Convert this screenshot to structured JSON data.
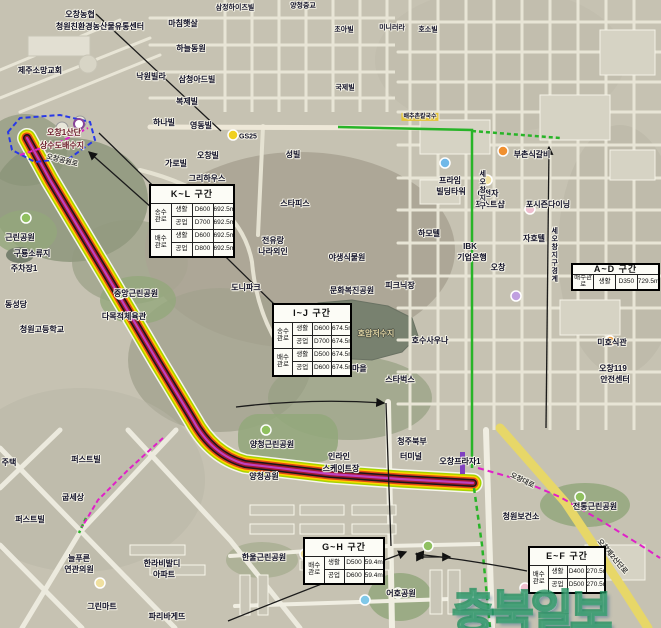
{
  "map": {
    "pipeline": {
      "colors": [
        "#f6f6ee",
        "#a8d400",
        "#ffd400",
        "#e04818",
        "#181818",
        "#a01830",
        "#c040c0"
      ]
    },
    "route_colors": {
      "green": "#28b428",
      "magenta": "#e020c8",
      "blue": "#2838e8",
      "yellow_road": "#e7d768"
    },
    "watermark": {
      "text": "충북일보"
    },
    "tables": [
      {
        "id": "KL",
        "title": "K~L 구간",
        "x": 149,
        "y": 184,
        "w": 86,
        "h": 74,
        "groups": [
          {
            "label": "송수\n관로",
            "rows": [
              [
                "생활",
                "D600",
                "692.5m"
              ],
              [
                "공업",
                "D700",
                "692.5m"
              ]
            ]
          },
          {
            "label": "배수\n관로",
            "rows": [
              [
                "생활",
                "D600",
                "692.5m"
              ],
              [
                "공업",
                "D800",
                "692.5m"
              ]
            ]
          }
        ]
      },
      {
        "id": "IJ",
        "title": "I~J 구간",
        "x": 272,
        "y": 303,
        "w": 80,
        "h": 74,
        "groups": [
          {
            "label": "송수\n관로",
            "rows": [
              [
                "생활",
                "D600",
                "674.5m"
              ],
              [
                "공업",
                "D700",
                "674.5m"
              ]
            ]
          },
          {
            "label": "배수\n관로",
            "rows": [
              [
                "생활",
                "D500",
                "674.5m"
              ],
              [
                "공업",
                "D600",
                "674.5m"
              ]
            ]
          }
        ]
      },
      {
        "id": "AD",
        "title": "A~D 구간",
        "x": 571,
        "y": 263,
        "w": 89,
        "h": 27,
        "groups": [
          {
            "label": "배수관로",
            "rows": [
              [
                "생활",
                "D350",
                "729.5m"
              ]
            ]
          }
        ]
      },
      {
        "id": "GH",
        "title": "G~H 구간",
        "x": 303,
        "y": 537,
        "w": 82,
        "h": 48,
        "groups": [
          {
            "label": "배수\n관로",
            "rows": [
              [
                "생활",
                "D500",
                "59.4m"
              ],
              [
                "공업",
                "D600",
                "59.4m"
              ]
            ]
          }
        ]
      },
      {
        "id": "EF",
        "title": "E~F 구간",
        "x": 528,
        "y": 546,
        "w": 78,
        "h": 48,
        "groups": [
          {
            "label": "배수\n관로",
            "rows": [
              [
                "생활",
                "D400",
                "270.5m"
              ],
              [
                "공업",
                "D500",
                "270.5m"
              ]
            ]
          }
        ]
      }
    ],
    "labels": [
      {
        "t": "오창농협",
        "x": 80,
        "y": 15
      },
      {
        "t": "청원친환경농산물유통센터",
        "x": 100,
        "y": 27
      },
      {
        "t": "제주소망교회",
        "x": 40,
        "y": 71
      },
      {
        "t": "마침햇살",
        "x": 183,
        "y": 24
      },
      {
        "t": "하늘동원",
        "x": 191,
        "y": 49
      },
      {
        "t": "낙원빌라",
        "x": 151,
        "y": 77
      },
      {
        "t": "삼청아드빌",
        "x": 197,
        "y": 80
      },
      {
        "t": "복제빌",
        "x": 187,
        "y": 102
      },
      {
        "t": "하나빌",
        "x": 164,
        "y": 123
      },
      {
        "t": "영동빌",
        "x": 201,
        "y": 126
      },
      {
        "t": "삼정하이츠빌",
        "x": 235,
        "y": 8,
        "s": 7
      },
      {
        "t": "양청중교",
        "x": 303,
        "y": 6,
        "s": 7
      },
      {
        "t": "초아빌",
        "x": 344,
        "y": 30,
        "s": 7
      },
      {
        "t": "미니러라",
        "x": 392,
        "y": 28,
        "s": 7
      },
      {
        "t": "호소빌",
        "x": 428,
        "y": 30,
        "s": 7
      },
      {
        "t": "국제빌",
        "x": 345,
        "y": 88,
        "s": 7
      },
      {
        "t": "성빌",
        "x": 293,
        "y": 155
      },
      {
        "t": "GS25",
        "x": 248,
        "y": 137,
        "s": 7
      },
      {
        "t": "오창빌",
        "x": 208,
        "y": 156
      },
      {
        "t": "가로빌",
        "x": 176,
        "y": 164
      },
      {
        "t": "그리하우스",
        "x": 207,
        "y": 179
      },
      {
        "t": "스타피스",
        "x": 295,
        "y": 204
      },
      {
        "t": "전유랑",
        "x": 273,
        "y": 241
      },
      {
        "t": "나라외인",
        "x": 273,
        "y": 252
      },
      {
        "t": "도니파크",
        "x": 246,
        "y": 288
      },
      {
        "t": "문화복진공원",
        "x": 352,
        "y": 291
      },
      {
        "t": "피크닉장",
        "x": 400,
        "y": 286
      },
      {
        "t": "야생식물원",
        "x": 347,
        "y": 258
      },
      {
        "t": "호암저수지",
        "x": 376,
        "y": 334,
        "c": "#ded2a2",
        "h": "d"
      },
      {
        "t": "호수사우나",
        "x": 430,
        "y": 341
      },
      {
        "t": "스타벅스",
        "x": 400,
        "y": 380
      },
      {
        "t": "석사마을",
        "x": 352,
        "y": 369
      },
      {
        "t": "중앙근린공원",
        "x": 136,
        "y": 294
      },
      {
        "t": "다목적체육관",
        "x": 124,
        "y": 317
      },
      {
        "t": "근린공원",
        "x": 20,
        "y": 238
      },
      {
        "t": "구룡소류지",
        "x": 32,
        "y": 254
      },
      {
        "t": "주차장1",
        "x": 24,
        "y": 269
      },
      {
        "t": "동성당",
        "x": 16,
        "y": 305
      },
      {
        "t": "청원고등학교",
        "x": 42,
        "y": 330
      },
      {
        "t": "오창1산단",
        "x": 64,
        "y": 133,
        "c": "#6b1a2a"
      },
      {
        "t": "상수도배수지",
        "x": 62,
        "y": 146,
        "c": "#6b1a2a"
      },
      {
        "t": "오창공원로",
        "x": 62,
        "y": 161,
        "s": 7,
        "r": 14,
        "c": "#3a3a3a"
      },
      {
        "t": "양청근린공원",
        "x": 272,
        "y": 445
      },
      {
        "t": "인라인",
        "x": 339,
        "y": 457
      },
      {
        "t": "스케이트장",
        "x": 341,
        "y": 469
      },
      {
        "t": "양청공원",
        "x": 264,
        "y": 477
      },
      {
        "t": "청주북부",
        "x": 412,
        "y": 442
      },
      {
        "t": "터미널",
        "x": 411,
        "y": 457
      },
      {
        "t": "오창프라자1",
        "x": 460,
        "y": 462
      },
      {
        "t": "오창대로",
        "x": 522,
        "y": 481,
        "r": 26,
        "s": 7,
        "c": "#3a3a3a"
      },
      {
        "t": "청원보건소",
        "x": 521,
        "y": 517
      },
      {
        "t": "전통근린공원",
        "x": 595,
        "y": 507
      },
      {
        "t": "어호공원",
        "x": 401,
        "y": 594
      },
      {
        "t": "퍼스트빌",
        "x": 86,
        "y": 460
      },
      {
        "t": "퍼스트빌",
        "x": 30,
        "y": 520
      },
      {
        "t": "굽세상",
        "x": 73,
        "y": 498
      },
      {
        "t": "늘푸른",
        "x": 79,
        "y": 559
      },
      {
        "t": "연관의원",
        "x": 79,
        "y": 570
      },
      {
        "t": "한라비발디",
        "x": 162,
        "y": 564
      },
      {
        "t": "아파트",
        "x": 164,
        "y": 575
      },
      {
        "t": "그린마트",
        "x": 102,
        "y": 607
      },
      {
        "t": "파리바게뜨",
        "x": 167,
        "y": 617
      },
      {
        "t": "주택",
        "x": 9,
        "y": 463
      },
      {
        "t": "한울근린공원",
        "x": 264,
        "y": 558
      },
      {
        "t": "하모텔",
        "x": 429,
        "y": 234
      },
      {
        "t": "프라임",
        "x": 450,
        "y": 181
      },
      {
        "t": "빌딩타워",
        "x": 451,
        "y": 192
      },
      {
        "t": "G전자",
        "x": 488,
        "y": 194
      },
      {
        "t": "포스트샵",
        "x": 490,
        "y": 205
      },
      {
        "t": "포시즌다이닝",
        "x": 548,
        "y": 205
      },
      {
        "t": "자호텔",
        "x": 534,
        "y": 239
      },
      {
        "t": "IBK",
        "x": 470,
        "y": 247
      },
      {
        "t": "기업은행",
        "x": 472,
        "y": 258
      },
      {
        "t": "오창",
        "x": 498,
        "y": 268
      },
      {
        "t": "부촌식갈비",
        "x": 532,
        "y": 155
      },
      {
        "t": "배추촌칼국수",
        "x": 420,
        "y": 117,
        "s": 6,
        "bg": "#e6c534"
      },
      {
        "t": "세오창지구",
        "x": 482,
        "y": 190,
        "v": true,
        "s": 7
      },
      {
        "t": "세오창지구경계",
        "x": 554,
        "y": 255,
        "v": true,
        "s": 7
      },
      {
        "t": "오창119",
        "x": 613,
        "y": 369
      },
      {
        "t": "안전센터",
        "x": 615,
        "y": 380
      },
      {
        "t": "미호식관",
        "x": 612,
        "y": 343
      },
      {
        "t": "오창제2산단로",
        "x": 612,
        "y": 557,
        "r": 50,
        "s": 7,
        "c": "#3a3a3a"
      }
    ]
  }
}
